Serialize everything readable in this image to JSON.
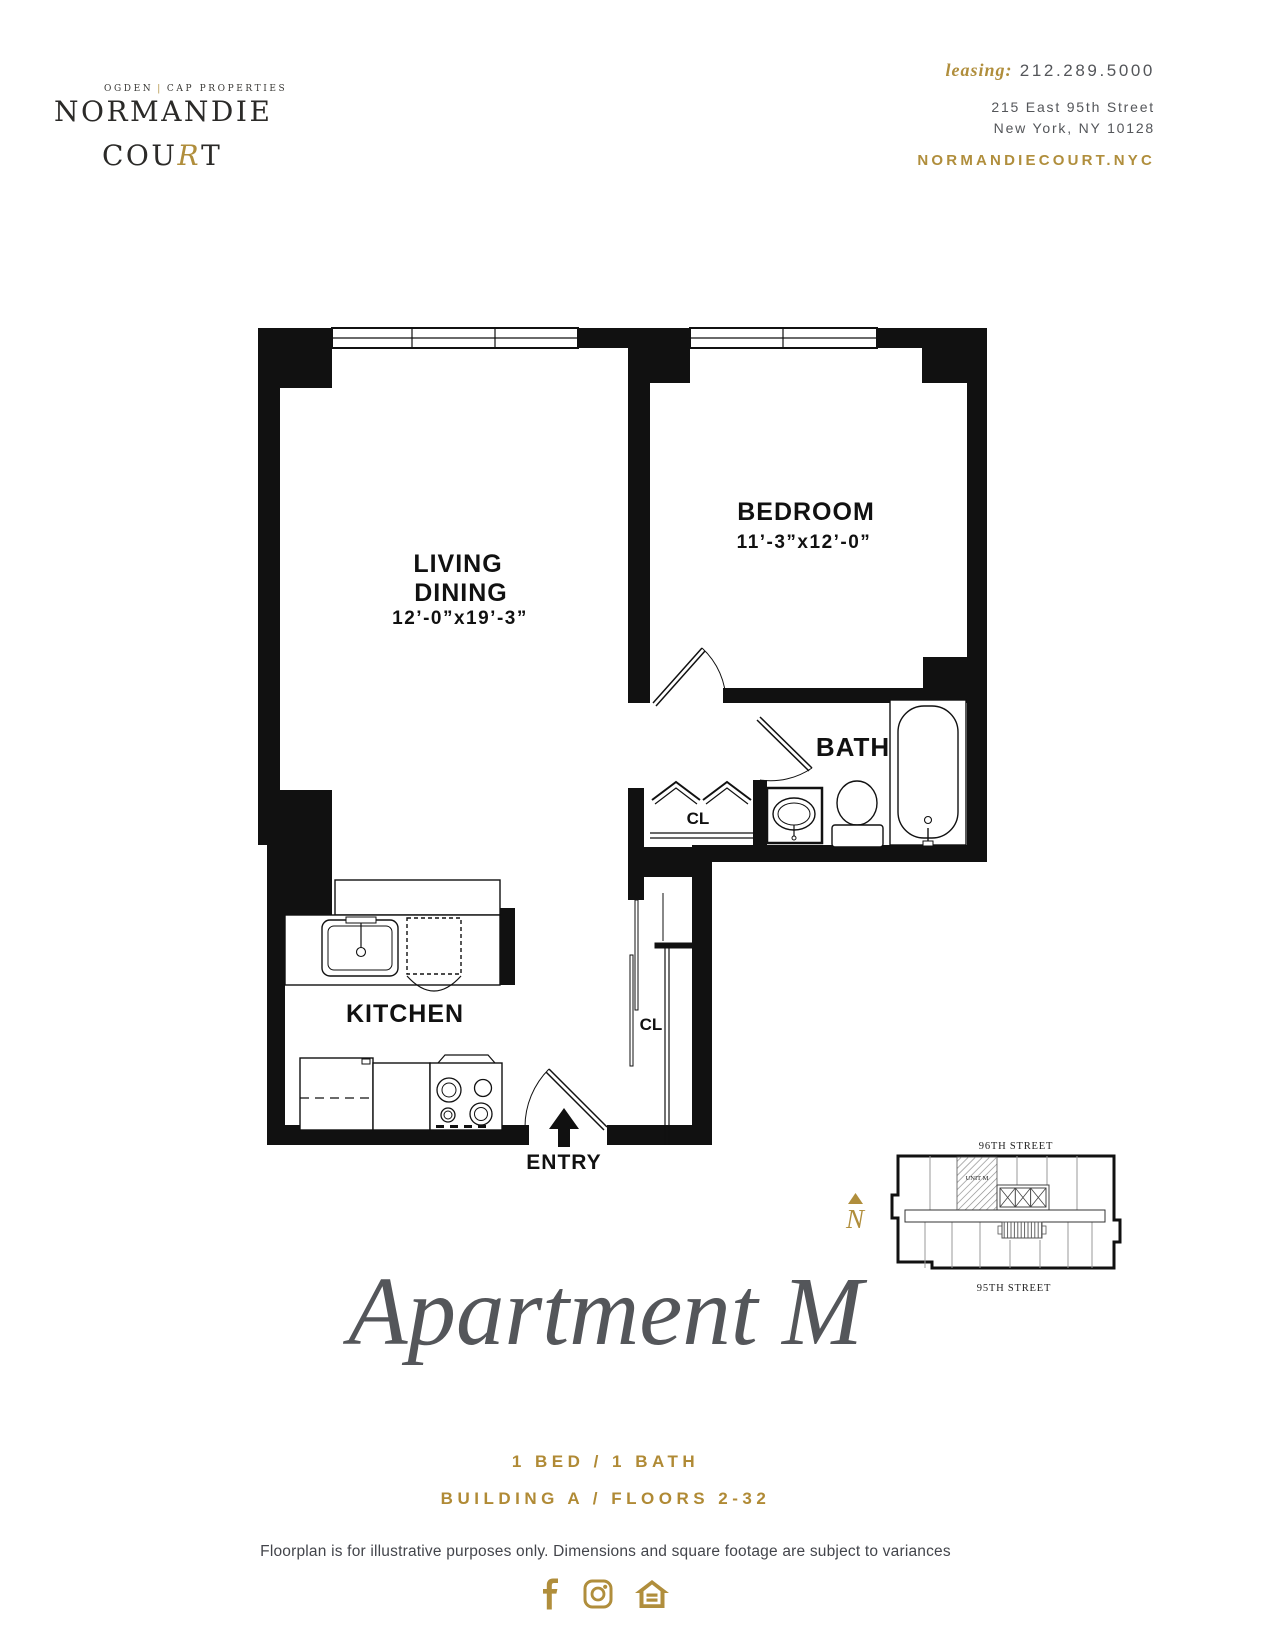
{
  "colors": {
    "gold": "#b08e3c",
    "dark_text": "#54565a",
    "plan_black": "#111111"
  },
  "header": {
    "brand": {
      "eyebrow_left": "OGDEN",
      "eyebrow_sep": "|",
      "eyebrow_right": "CAP PROPERTIES",
      "name_line1": "NORMANDIE",
      "court_pre": "COU",
      "court_r": "R",
      "court_post": "T"
    },
    "contact": {
      "leasing_label": "leasing:",
      "phone": "212.289.5000",
      "address_line1": "215 East 95th Street",
      "address_line2": "New York, NY 10128",
      "website": "NORMANDIECOURT.NYC"
    }
  },
  "floorplan": {
    "living": {
      "line1": "LIVING",
      "line2": "DINING",
      "dims": "12’-0”x19’-3”"
    },
    "bedroom": {
      "label": "BEDROOM",
      "dims": "11’-3”x12’-0”"
    },
    "bath": {
      "label": "BATH"
    },
    "hall_closet": {
      "label": "CL"
    },
    "entry_closet": {
      "label": "CL"
    },
    "kitchen": {
      "label": "KITCHEN"
    },
    "entry": {
      "label": "ENTRY"
    }
  },
  "sitemap": {
    "street_top": "96TH STREET",
    "street_bottom": "95TH STREET",
    "unit_label": "UNIT M",
    "north_label": "N"
  },
  "footer": {
    "title": "Apartment M",
    "spec_line1": "1 BED / 1 BATH",
    "spec_line2": "BUILDING A / FLOORS 2-32",
    "disclaimer": "Floorplan is for illustrative purposes only. Dimensions and square footage are subject to variances",
    "social": {
      "facebook": "facebook",
      "instagram": "instagram",
      "home": "equal-housing-home"
    }
  }
}
